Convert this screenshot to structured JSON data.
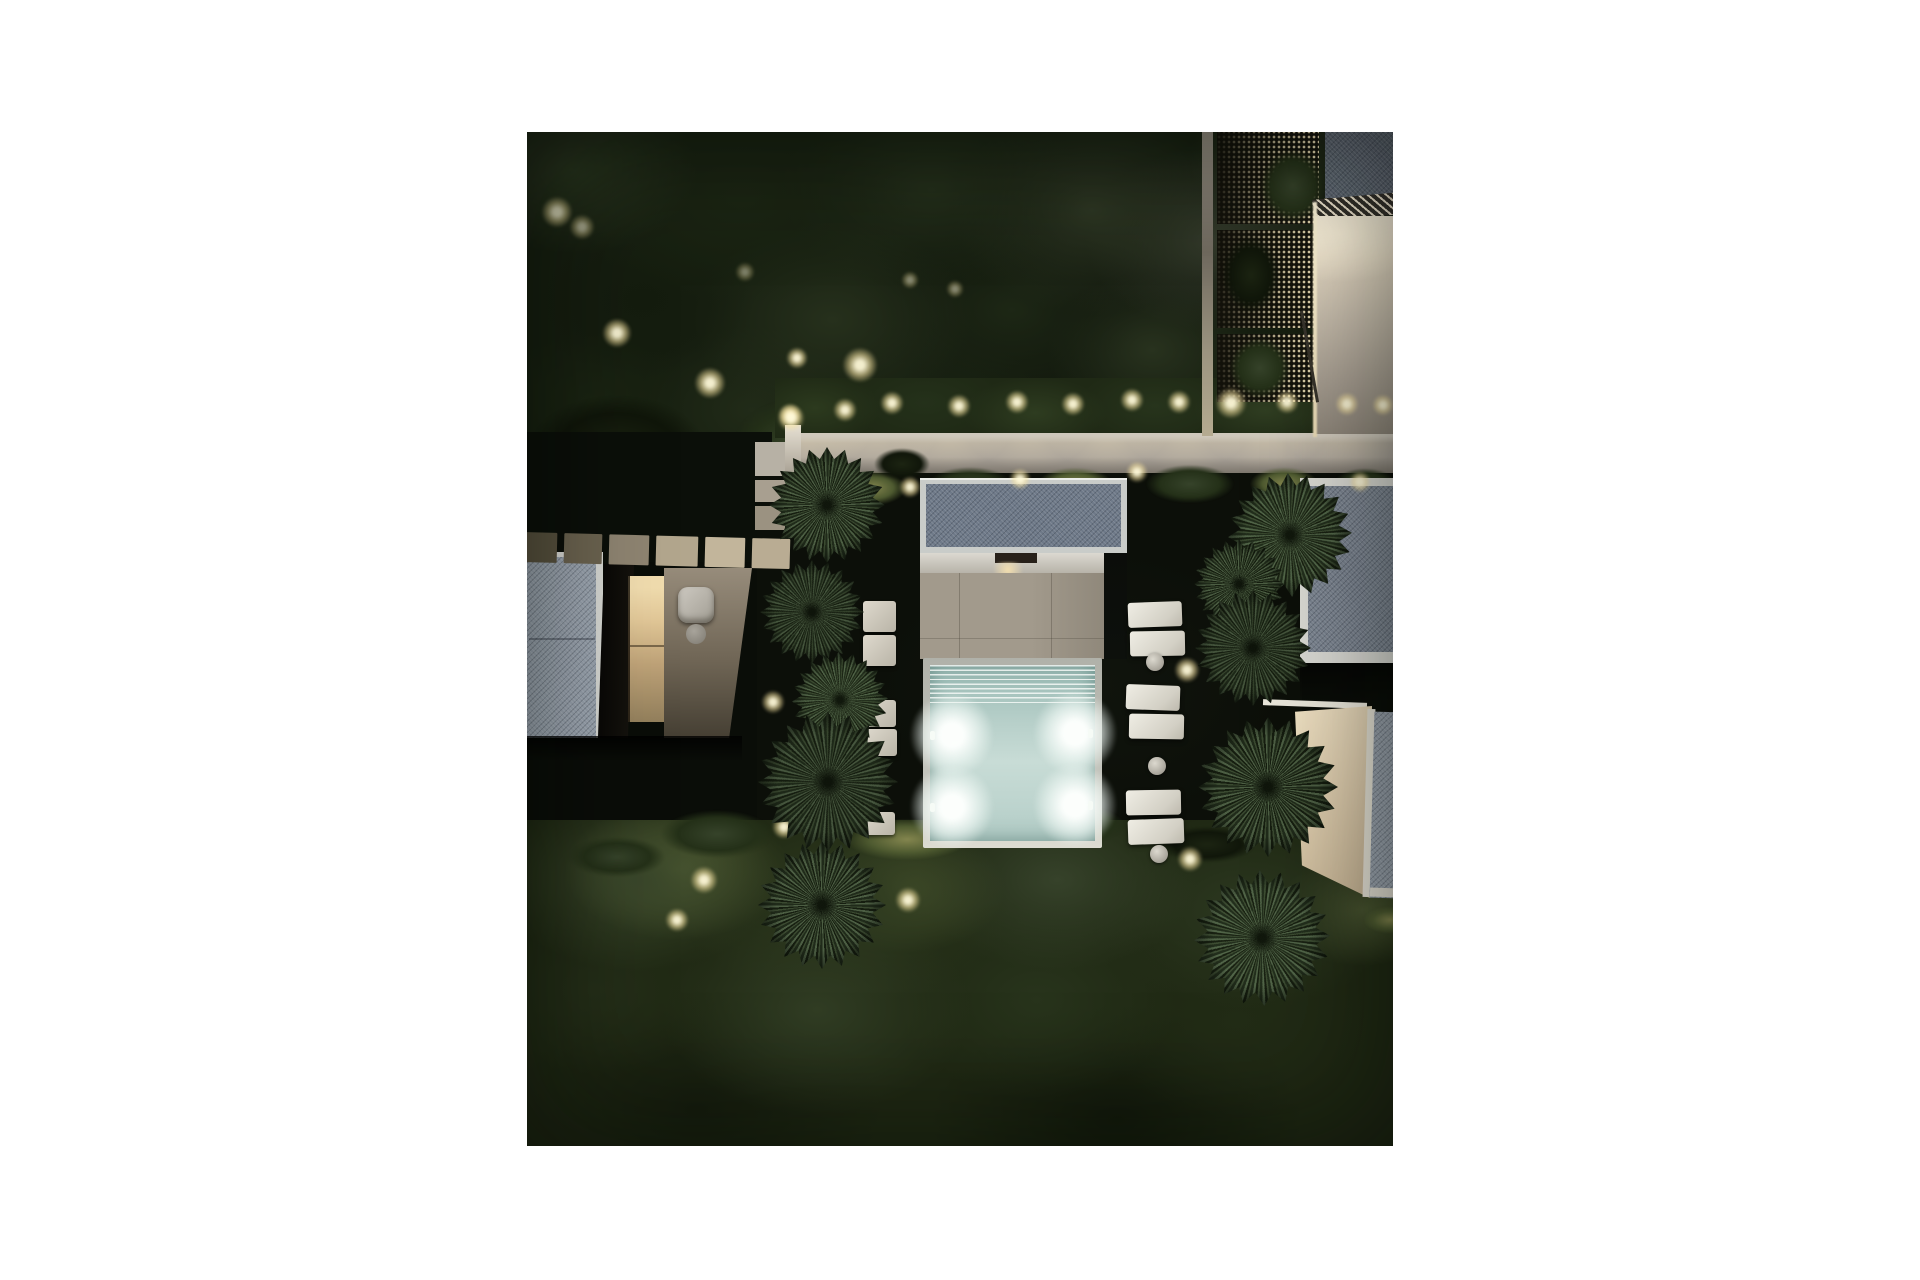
{
  "meta": {
    "title": "Aerial night view of a minimalist villa garden with illuminated plunge pool",
    "type": "photorealistic architectural render",
    "view": "top-down aerial",
    "time_of_day": "night"
  },
  "scene": {
    "pool": {
      "water_color": "#c8dcd6",
      "underwater_light_count": 4,
      "step_count": 8
    },
    "palms": {
      "count": 10,
      "arrangement": "two rows flanking the pool courtyard"
    },
    "buildings": {
      "count": 5,
      "roof_material": "gray gravel with white trim"
    },
    "garden_lights": {
      "count": 24,
      "color": "#f5e7b4"
    },
    "furniture": {
      "ottoman_cushions": 11,
      "side_tables": 3,
      "armchairs": 1
    },
    "paths": {
      "stepping_stone_pavers": 9
    }
  },
  "palette": {
    "page_background": "#ffffff",
    "foliage_dark": "#1a2413",
    "foliage_olive": "#2e3a1f",
    "garden_wall": "#a9a299",
    "patio": "#a29a8c",
    "roof_gray": "#6e7988",
    "warm_light": "#f2e3ae",
    "cushion_white": "#e8e5dc"
  }
}
